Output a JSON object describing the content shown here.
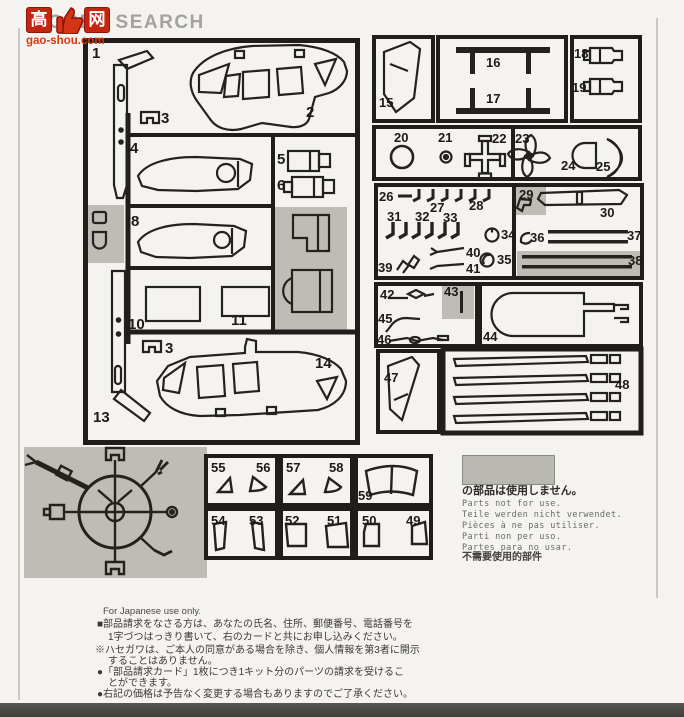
{
  "watermark": {
    "kanji_left": "高",
    "kanji_right": "网",
    "brand": "HOBBY SEARCH",
    "site": "gao-shou.com"
  },
  "colors": {
    "paper": "#f4f3ef",
    "ink": "#1f1e1b",
    "unused_shade": "#bdbcb5",
    "watermark_red": "#c42510",
    "bottom_bar": "#4c4b47"
  },
  "parts": {
    "n1": "1",
    "n2": "2",
    "n3": "3",
    "n4": "4",
    "n5": "5",
    "n6": "6",
    "n8": "8",
    "n10": "10",
    "n11": "11",
    "n13": "13",
    "n14": "14",
    "n15": "15",
    "n16": "16",
    "n17": "17",
    "n18": "18",
    "n19": "19",
    "n20": "20",
    "n21": "21",
    "n22": "22",
    "n23": "23",
    "n24": "24",
    "n25": "25",
    "n26": "26",
    "n27": "27",
    "n28": "28",
    "n29": "29",
    "n30": "30",
    "n31": "31",
    "n32": "32",
    "n33": "33",
    "n34": "34",
    "n35": "35",
    "n36": "36",
    "n37": "37",
    "n38": "38",
    "n39": "39",
    "n40": "40",
    "n41": "41",
    "n42": "42",
    "n43": "43",
    "n44": "44",
    "n45": "45",
    "n46": "46",
    "n47": "47",
    "n48": "48",
    "n49": "49",
    "n50": "50",
    "n51": "51",
    "n52": "52",
    "n53": "53",
    "n54": "54",
    "n55": "55",
    "n56": "56",
    "n57": "57",
    "n58": "58",
    "n59": "59"
  },
  "unused_legend": {
    "swatch_caption": "の部品は使用しません。",
    "translations": [
      "Parts not for use.",
      "Teile werden nicht verwendet.",
      "Pièces à ne pas utiliser.",
      "Parti non per uso.",
      "Partes para no usar."
    ],
    "chinese": "不需要使用的部件"
  },
  "footer": {
    "heading": "For Japanese use only.",
    "lines": [
      "■部品請求をなさる方は、あなたの氏名、住所、郵便番号、電話番号を",
      "1字づつはっきり書いて、右のカードと共にお申し込みください。",
      "※ハセガワは、ご本人の同意がある場合を除き、個人情報を第3者に開示",
      "することはありません。",
      "●「部品請求カード」1枚につき1キット分のパーツの請求を受けるこ",
      "とができます。",
      "●右記の価格は予告なく変更する場合もありますのでご了承ください。"
    ]
  }
}
